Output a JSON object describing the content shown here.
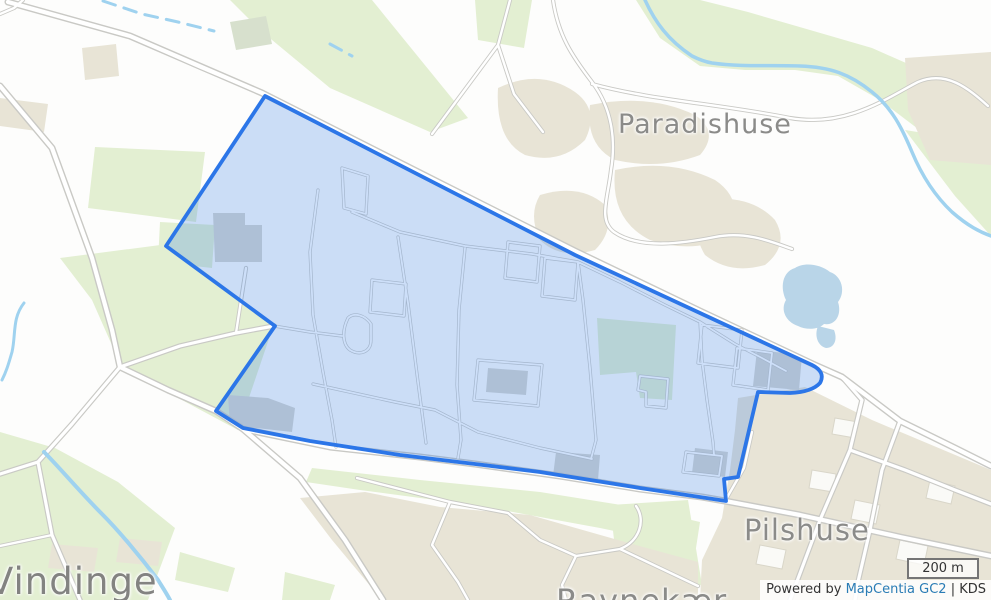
{
  "map": {
    "place_labels": {
      "paradishuse": "Paradishuse",
      "pilshuse": "Pilshuse",
      "vindinge": "Vindinge",
      "ravnekaer": "Ravnekær"
    },
    "scale_bar": {
      "label": "200 m"
    },
    "attribution": {
      "prefix": "Powered by ",
      "link_label": "MapCentia GC2",
      "suffix": " | KDS"
    },
    "colors": {
      "selection_stroke": "#2c76e8",
      "selection_fill": "rgba(47,121,232,0.24)",
      "water": "#9fd2ef",
      "greenery": "#e3efd2",
      "builtup_beige": "#e8e4d6",
      "building_gray": "#d6d6d2",
      "road_casing": "#c9c9c5",
      "road_fill": "#ffffff",
      "place_label_text": "#8b8b89",
      "attribution_link": "#2a7cb5"
    }
  }
}
